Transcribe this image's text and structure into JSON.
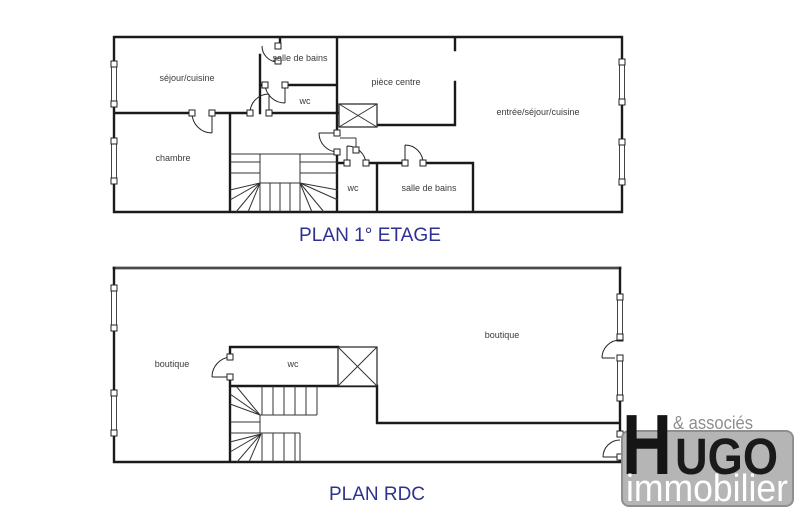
{
  "floor1": {
    "title": "PLAN 1° ETAGE",
    "rooms": {
      "sejour_cuisine": "séjour/cuisine",
      "salle_de_bains_haut": "salle de bains",
      "wc_haut": "wc",
      "piece_centre": "pièce centre",
      "entree_sejour_cuisine": "entrée/séjour/cuisine",
      "chambre": "chambre",
      "wc_bas": "wc",
      "salle_de_bains_bas": "salle de bains"
    }
  },
  "rdc": {
    "title": "PLAN RDC",
    "rooms": {
      "boutique_gauche": "boutique",
      "wc": "wc",
      "boutique_droite": "boutique"
    }
  },
  "logo": {
    "initial": "H",
    "rest": "UGO",
    "tagline": "& associés",
    "subtitle": "immobilier"
  },
  "colors": {
    "wall_black": "#1a1a1a",
    "title_navy": "#2e3192",
    "label_gray": "#3b3b3b",
    "rdc_top_wall_gray": "#4a4a4a",
    "logo_box_gray": "#b5b5b5",
    "logo_box_border_gray": "#8f8f8f",
    "logo_tagline_gray": "#8f8f8f"
  }
}
